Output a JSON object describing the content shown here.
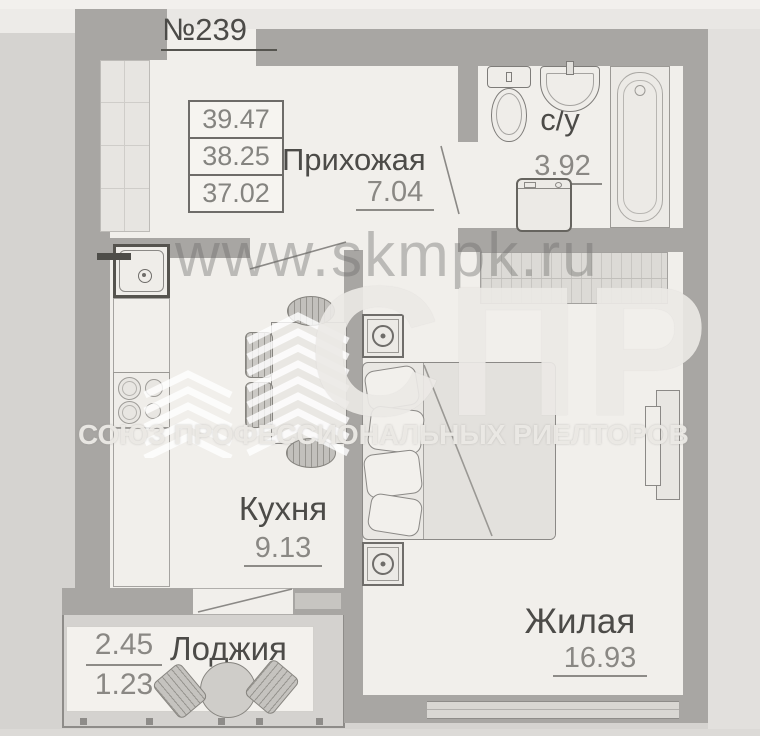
{
  "apartment": {
    "number": "№239"
  },
  "area_table": {
    "values": [
      "39.47",
      "38.25",
      "37.02"
    ]
  },
  "rooms": {
    "hallway": {
      "label": "Прихожая",
      "area": "7.04"
    },
    "bathroom": {
      "label": "с/у",
      "area": "3.92"
    },
    "kitchen": {
      "label": "Кухня",
      "area": "9.13"
    },
    "living": {
      "label": "Жилая",
      "area": "16.93"
    },
    "loggia": {
      "label": "Лоджия",
      "area_full": "2.45",
      "area_reduced": "1.23"
    }
  },
  "watermark": {
    "site": "www.skmpk.ru",
    "acronym": "СПР",
    "org": "СОЮЗ ПРОФЕССИОНАЛЬНЫХ РИЕЛТОРОВ"
  },
  "colors": {
    "wall": "#a8a6a3",
    "paper": "#f1efeb",
    "photo_bg": "#d5d3d0",
    "text_dark": "#4c4b48",
    "text_gray": "#8a8884"
  }
}
